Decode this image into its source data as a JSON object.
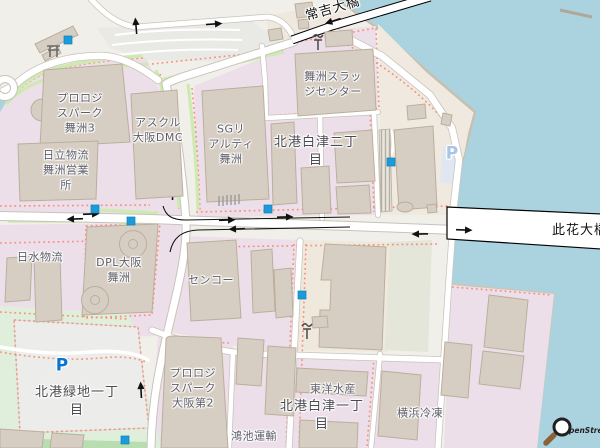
{
  "map": {
    "type": "openstreetmap-tile-view",
    "location": "Maishima / Hokko industrial waterfront, Osaka"
  },
  "labels": {
    "prologis3": {
      "lines": [
        "プロロジ",
        "スパーク",
        "舞洲3"
      ]
    },
    "hitachi": {
      "lines": [
        "日立物流",
        "舞洲営業",
        "所"
      ]
    },
    "askul": {
      "lines": [
        "アスクル",
        "大阪DMC"
      ]
    },
    "sg_realty": {
      "lines": [
        "SGリ",
        "アルティ",
        "舞洲"
      ]
    },
    "sludge_center": {
      "lines": [
        "舞洲スラッ",
        "ジセンター"
      ]
    },
    "hokko_shiratsu2": {
      "lines": [
        "北港白津二丁",
        "目"
      ]
    },
    "nissui": {
      "lines": [
        "日水物流"
      ]
    },
    "dpl": {
      "lines": [
        "DPL大阪",
        "舞洲"
      ]
    },
    "senko": {
      "lines": [
        "センコー"
      ]
    },
    "hokko_ryokuchi1": {
      "lines": [
        "北港緑地一丁",
        "目"
      ]
    },
    "prologis_osaka2": {
      "lines": [
        "プロロジ",
        "スパーク",
        "大阪第2"
      ]
    },
    "konoike": {
      "lines": [
        "鴻池運輸"
      ]
    },
    "toyo_suisan": {
      "lines": [
        "東洋水産"
      ]
    },
    "hokko_shiratsu1": {
      "lines": [
        "北港白津一丁",
        "目"
      ]
    },
    "yokohama_reizo": {
      "lines": [
        "横浜冷凍"
      ]
    }
  },
  "road_labels": {
    "tsuneyoshi_bridge": "常吉大橋",
    "konohana_bridge": "此花大橋"
  },
  "icons": {
    "parking_letter": "P",
    "marker": "blue-square-marker",
    "crane": "crane-icon",
    "shrine": "torii-icon",
    "magnifier": "magnifier-icon"
  },
  "attribution": {
    "visible_text": "penStreetMap",
    "full_name": "OpenStreetMap"
  },
  "colors": {
    "land": "#f1efe9",
    "water": "#abd3df",
    "industrial": "#ecdfe9",
    "commercial_beige": "#efe9dd",
    "lot_graygreen": "#e3e6d9",
    "park": "#e0efdb",
    "building": "#d7cec3",
    "building_border": "#bcae9c",
    "road": "#ffffff",
    "road_casing": "#c8c3ba",
    "green_verge": "#cdeab0",
    "footway": "#f98a76",
    "marker_blue": "#1b9cd8"
  }
}
